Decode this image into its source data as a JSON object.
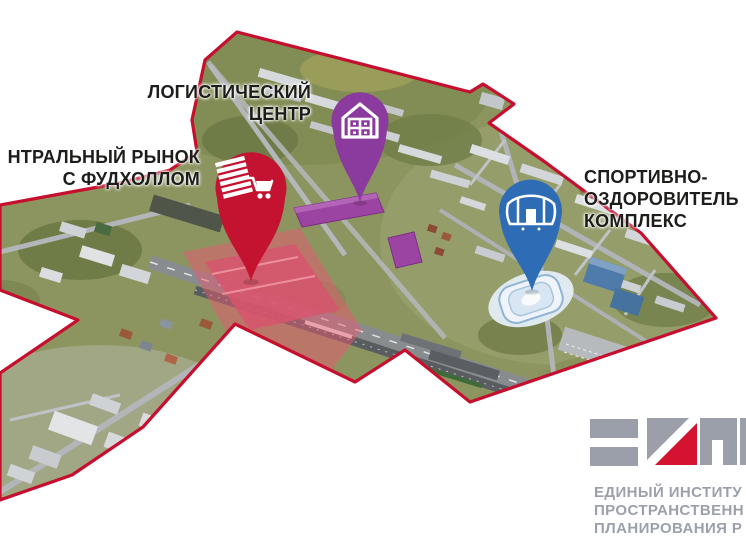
{
  "map": {
    "boundary_color": "#c60f2e",
    "base_land_color": "#8c9560"
  },
  "markers": [
    {
      "id": "central-market",
      "color": "#c31331",
      "icon": "market-cart-icon",
      "label_lines": [
        "НТРАЛЬНЫЙ РЫНОК",
        "С ФУДХОЛЛОМ"
      ]
    },
    {
      "id": "logistics-center",
      "color": "#8b3a9d",
      "icon": "warehouse-icon",
      "label_lines": [
        "ЛОГИСТИЧЕСКИЙ",
        "ЦЕНТР"
      ]
    },
    {
      "id": "sports-complex",
      "color": "#2e6cb5",
      "icon": "stadium-icon",
      "label_lines": [
        "СПОРТИВНО-",
        "ОЗДОРОВИТЕЛЬ",
        "КОМПЛЕКС"
      ]
    }
  ],
  "highlights": {
    "market_area": "#e85a72",
    "market_buildings": "#d6556d",
    "logistics_buildings": "#9c44a2",
    "sports_arena": "#eef4f9"
  },
  "logo": {
    "mark_gray": "#9b9fa9",
    "mark_red": "#d3132f",
    "lines": [
      "ЕДИНЫЙ ИНСТИТУ",
      "ПРОСТРАНСТВЕНН",
      "ПЛАНИРОВАНИЯ Р"
    ]
  }
}
